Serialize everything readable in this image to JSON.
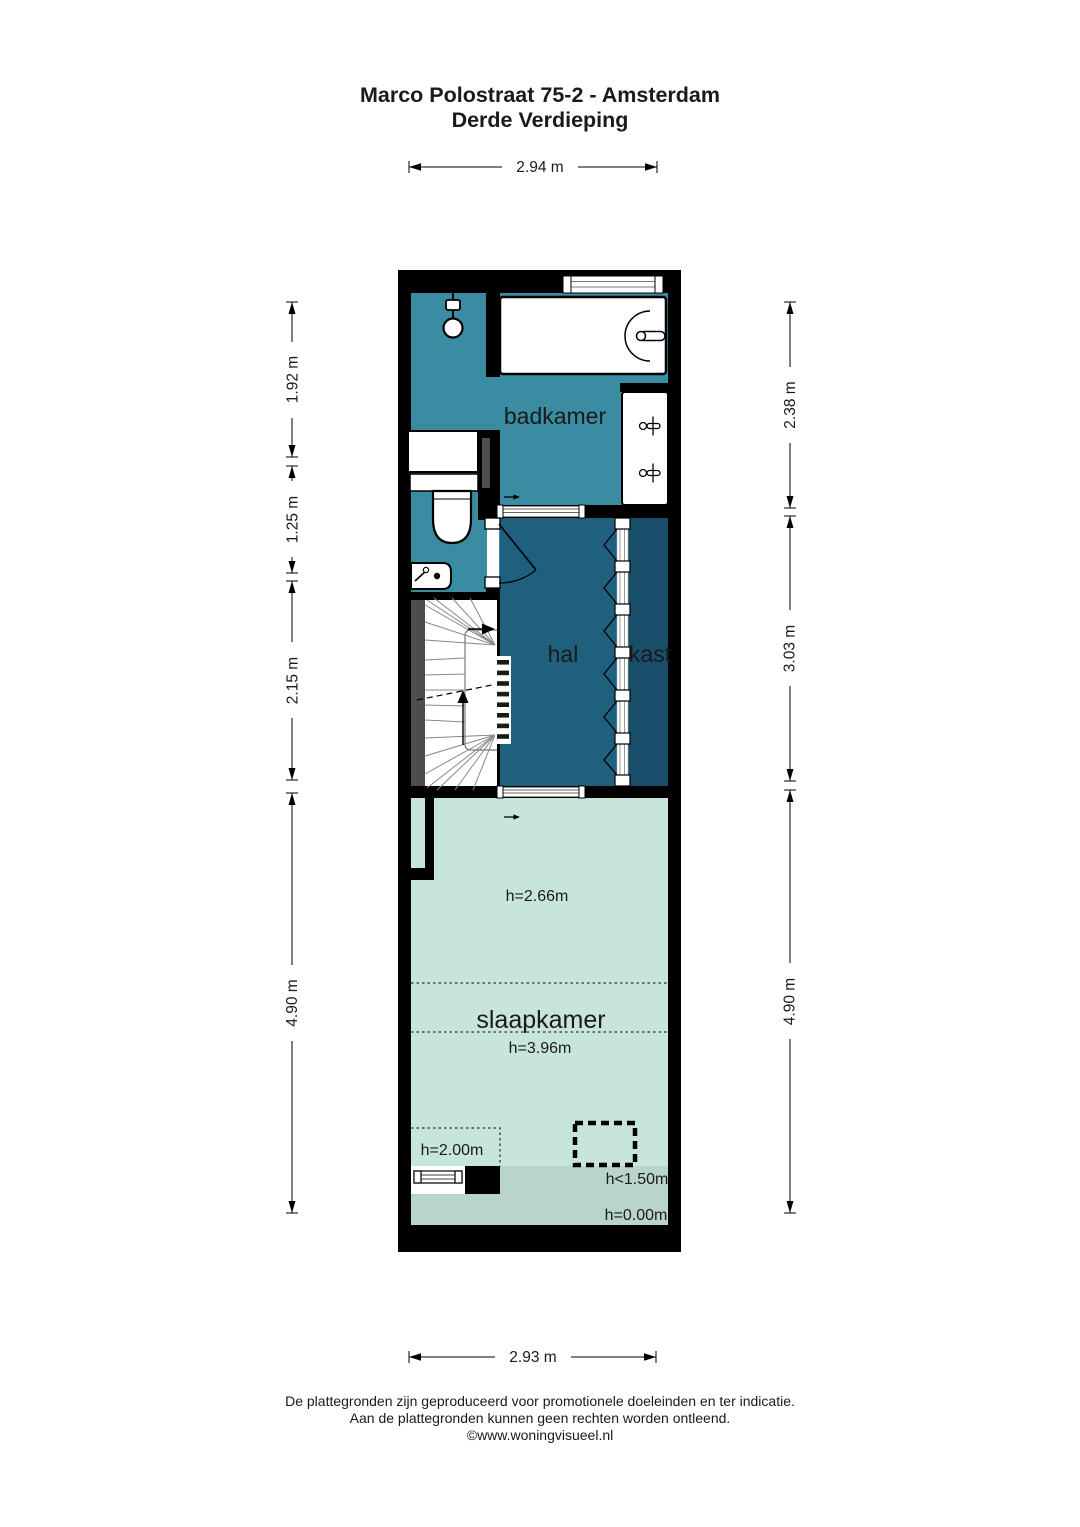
{
  "title": {
    "line1": "Marco Polostraat 75-2 - Amsterdam",
    "line2": "Derde Verdieping"
  },
  "dimensions": {
    "top": "2.94 m",
    "bottom": "2.93 m",
    "left": [
      "1.92 m",
      "1.25 m",
      "2.15 m",
      "4.90 m"
    ],
    "right": [
      "2.38 m",
      "3.03 m",
      "4.90 m"
    ]
  },
  "rooms": {
    "badkamer": "badkamer",
    "hal": "hal",
    "kast": "kast",
    "slaapkamer": "slaapkamer"
  },
  "heights": {
    "flat": "h=2.66m",
    "slope_high": "h=3.96m",
    "slope_left": "h=2.00m",
    "slope_low": "h<1.50m",
    "floor": "h=0.00m"
  },
  "footer": {
    "line1": "De plattegronden zijn geproduceerd voor promotionele doeleinden en ter indicatie.",
    "line2": "Aan de plattegronden kunnen geen rechten worden ontleend.",
    "line3": "©www.woningvisueel.nl"
  },
  "colors": {
    "wall": "#000000",
    "badkamer": "#3a8ca2",
    "hal": "#20607f",
    "kast": "#194f6b",
    "slaapkamer": "#c8e5db",
    "slaapkamer_low": "#b9d4ca",
    "chimney": "#4d4d4d"
  }
}
